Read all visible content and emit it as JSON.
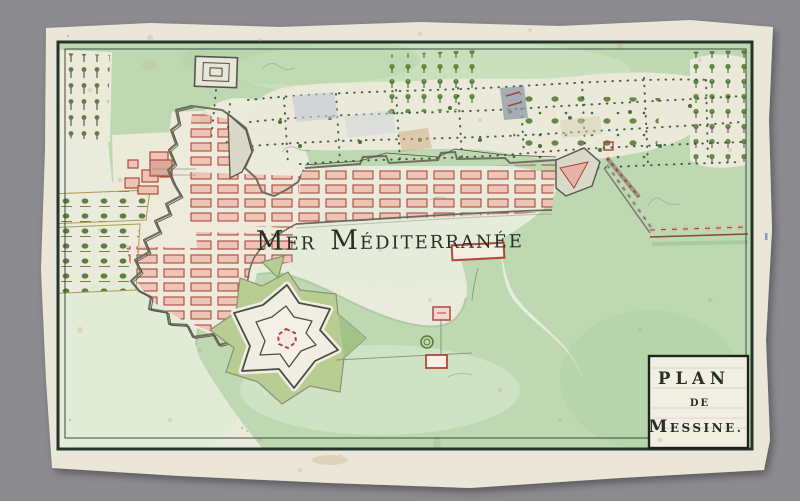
{
  "scene": {
    "background_color": "#8c8b90",
    "paper_color": "#eae7d8"
  },
  "map": {
    "sea_label": {
      "word1_initial": "M",
      "word1_rest": "ER",
      "word2_initial": "M",
      "word2_rest": "ÉDITERRANÉE"
    },
    "cartouche": {
      "line1": "PLAN",
      "line2": "DE",
      "line3_initial": "M",
      "line3_rest": "ESSINE."
    },
    "colors": {
      "sea_wash": "#e9ecdc",
      "land_green": "#bed9b2",
      "glacis_green": "#b7cd92",
      "city_block_fill": "#eec4b6",
      "city_block_stroke": "#ad4a3c",
      "wall_gray": "#70705f",
      "rampart_red": "#8a4636",
      "frame_ink": "#24332b",
      "label_ink": "#262f28"
    }
  }
}
